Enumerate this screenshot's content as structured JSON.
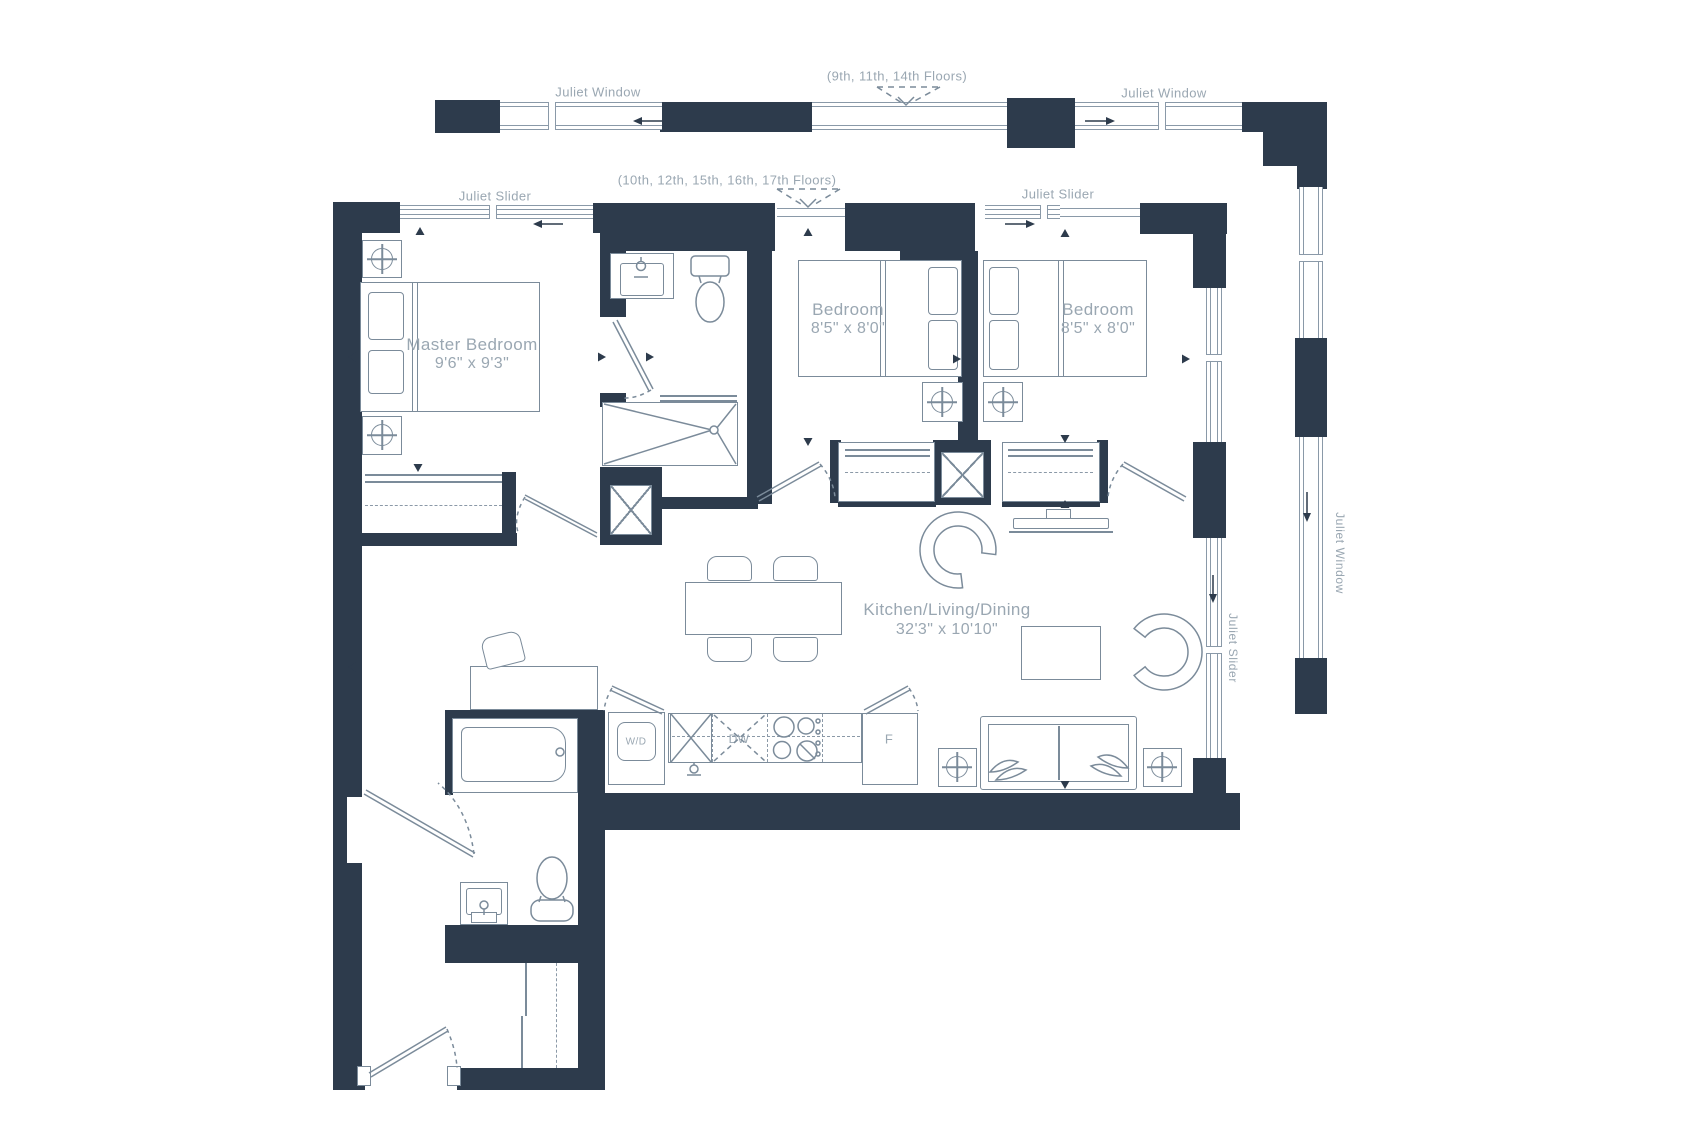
{
  "colors": {
    "wall": "#2d3b4c",
    "fixture_line": "#7b8b9a",
    "window_line": "#8a99a8",
    "label_text": "#9aa7b2",
    "background": "#ffffff"
  },
  "notes": {
    "upper_floors": "(9th, 11th, 14th Floors)",
    "lower_floors": "(10th, 12th, 15th, 16th, 17th Floors)"
  },
  "windows": {
    "juliet_window": "Juliet Window",
    "juliet_slider": "Juliet Slider"
  },
  "rooms": {
    "master_bedroom": {
      "name": "Master Bedroom",
      "dims": "9'6\" x 9'3\""
    },
    "bedroom_a": {
      "name": "Bedroom",
      "dims": "8'5\" x 8'0\""
    },
    "bedroom_b": {
      "name": "Bedroom",
      "dims": "8'5\" x 8'0\""
    },
    "kitchen_living_dining": {
      "name": "Kitchen/Living/Dining",
      "dims": "32'3\" x 10'10\""
    }
  },
  "appliances": {
    "washer_dryer": "W/D",
    "dishwasher": "DW",
    "fridge": "F"
  }
}
